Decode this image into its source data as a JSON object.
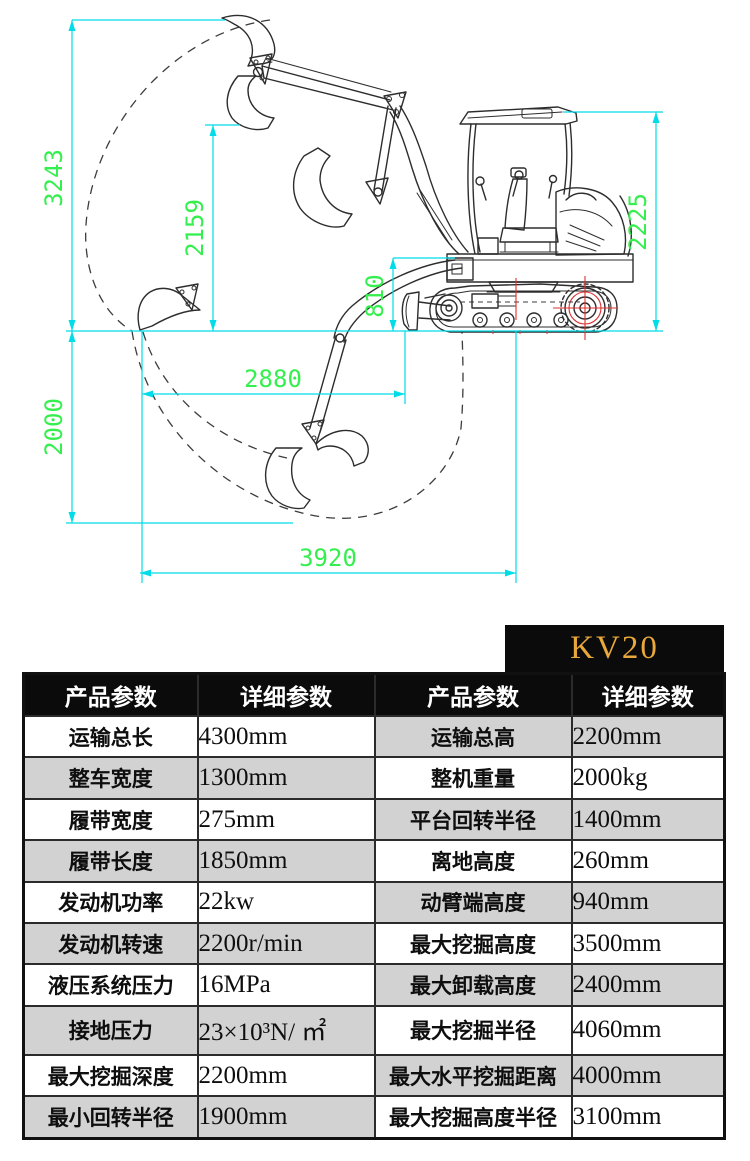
{
  "model_badge": "KV20",
  "diagram": {
    "dims": {
      "left_total_height": "3243",
      "inner_height": "2159",
      "platform_height": "810",
      "machine_height": "2225",
      "depth": "2000",
      "mid_reach": "2880",
      "ground_reach": "3920"
    }
  },
  "table": {
    "headers": [
      "产品参数",
      "详细参数",
      "产品参数",
      "详细参数"
    ],
    "rows": [
      {
        "left_label": "运输总长",
        "left_value": "4300mm",
        "right_label": "运输总高",
        "right_value": "2200mm"
      },
      {
        "left_label": "整车宽度",
        "left_value": "1300mm",
        "right_label": "整机重量",
        "right_value": "2000kg"
      },
      {
        "left_label": "履带宽度",
        "left_value": "275mm",
        "right_label": "平台回转半径",
        "right_value": "1400mm"
      },
      {
        "left_label": "履带长度",
        "left_value": "1850mm",
        "right_label": "离地高度",
        "right_value": "260mm"
      },
      {
        "left_label": "发动机功率",
        "left_value": "22kw",
        "right_label": "动臂端高度",
        "right_value": "940mm"
      },
      {
        "left_label": "发动机转速",
        "left_value": "2200r/min",
        "right_label": "最大挖掘高度",
        "right_value": "3500mm"
      },
      {
        "left_label": "液压系统压力",
        "left_value": "16MPa",
        "right_label": "最大卸载高度",
        "right_value": "2400mm"
      },
      {
        "left_label": "接地压力",
        "left_value": "23×10³N/ ㎡",
        "right_label": "最大挖掘半径",
        "right_value": "4060mm"
      },
      {
        "left_label": "最大挖掘深度",
        "left_value": "2200mm",
        "right_label": "最大水平挖掘距离",
        "right_value": "4000mm"
      },
      {
        "left_label": "最小回转半径",
        "left_value": "1900mm",
        "right_label": "最大挖掘高度半径",
        "right_value": "3100mm"
      }
    ]
  },
  "colors": {
    "accent_gold": "#E9A83B",
    "dim_line": "#00DCE8",
    "dim_text": "#35EF4E",
    "row_alt": "#d2d2d2",
    "header_bg": "#0b0b0b",
    "centerline_red": "#E03030"
  }
}
